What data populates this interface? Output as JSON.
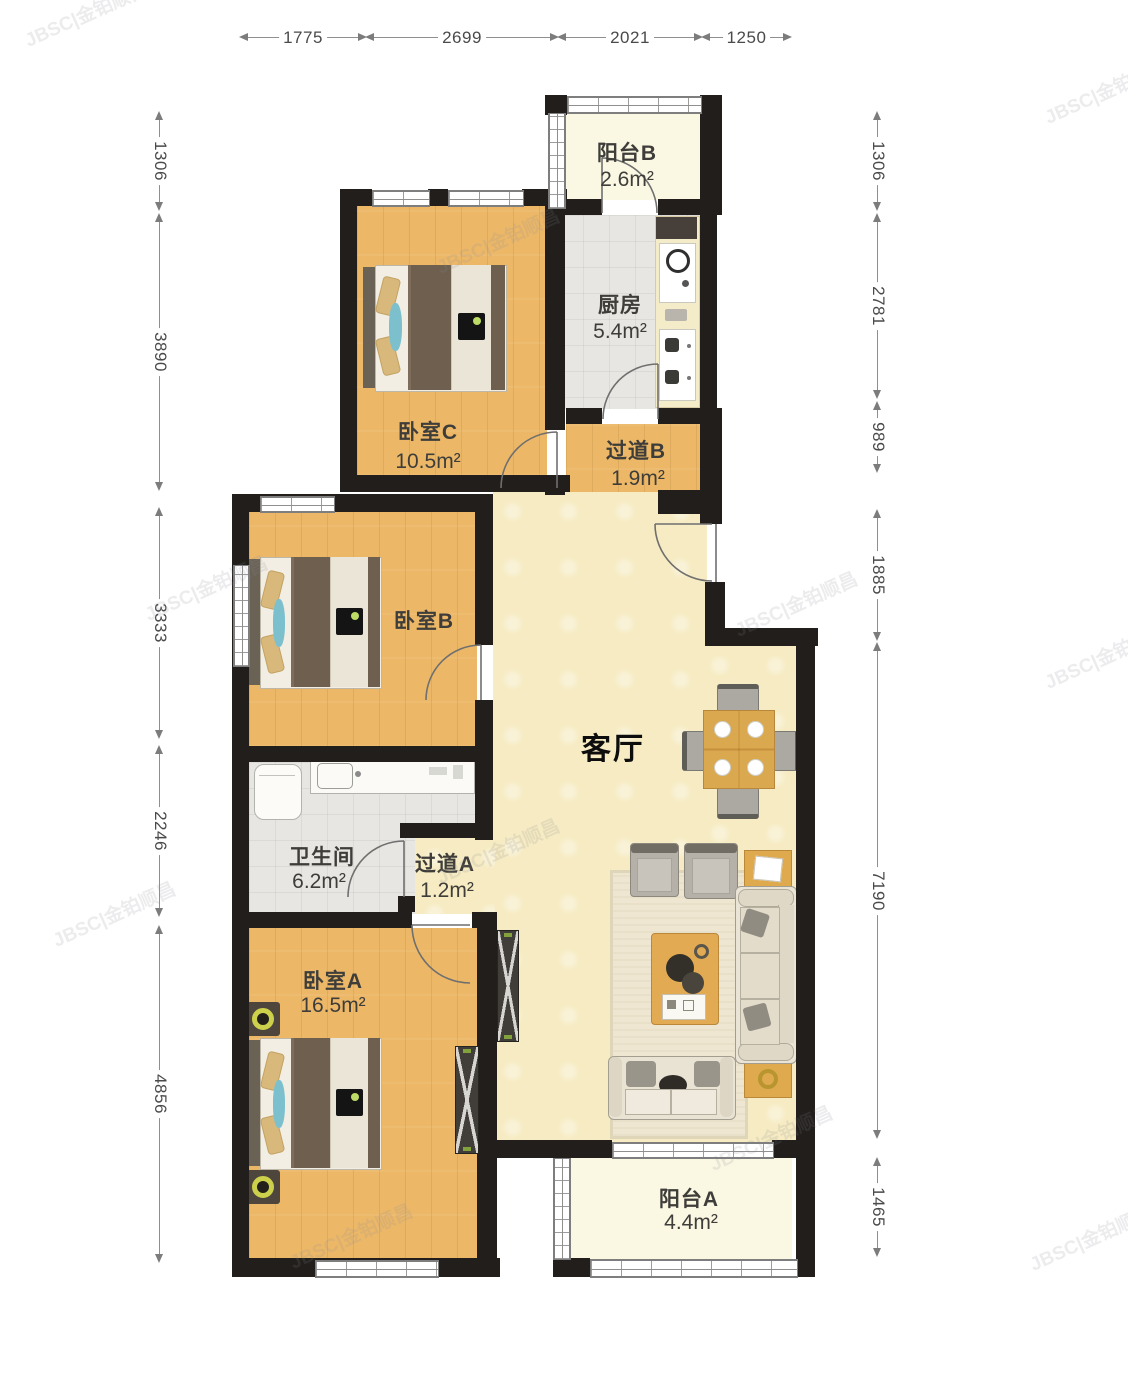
{
  "watermark": "JBSC|金铂顺昌",
  "rooms": {
    "balcony_b": {
      "name": "阳台B",
      "area": "2.6m²"
    },
    "kitchen": {
      "name": "厨房",
      "area": "5.4m²"
    },
    "bedroom_c": {
      "name": "卧室C",
      "area": "10.5m²"
    },
    "hallway_b": {
      "name": "过道B",
      "area": "1.9m²"
    },
    "bedroom_b": {
      "name": "卧室B"
    },
    "living_room": {
      "name": "客厅"
    },
    "bathroom": {
      "name": "卫生间",
      "area": "6.2m²"
    },
    "hallway_a": {
      "name": "过道A",
      "area": "1.2m²"
    },
    "bedroom_a": {
      "name": "卧室A",
      "area": "16.5m²"
    },
    "balcony_a": {
      "name": "阳台A",
      "area": "4.4m²"
    }
  },
  "dimensions": {
    "top": [
      {
        "value": "1775"
      },
      {
        "value": "2699"
      },
      {
        "value": "2021"
      },
      {
        "value": "1250"
      }
    ],
    "left": [
      {
        "value": "1306"
      },
      {
        "value": "3890"
      },
      {
        "value": "3333"
      },
      {
        "value": "2246"
      },
      {
        "value": "4856"
      }
    ],
    "right": [
      {
        "value": "1306"
      },
      {
        "value": "2781"
      },
      {
        "value": "989"
      },
      {
        "value": "1885"
      },
      {
        "value": "7190"
      },
      {
        "value": "1465"
      }
    ]
  },
  "colors": {
    "wall": "#211e1b",
    "wood_floor": "#ECB868",
    "living_floor": "#F6EBC2",
    "tile_floor": "#E7E6E2",
    "balcony_floor": "#FAF7E2",
    "accent_table": "#DAA84F"
  }
}
